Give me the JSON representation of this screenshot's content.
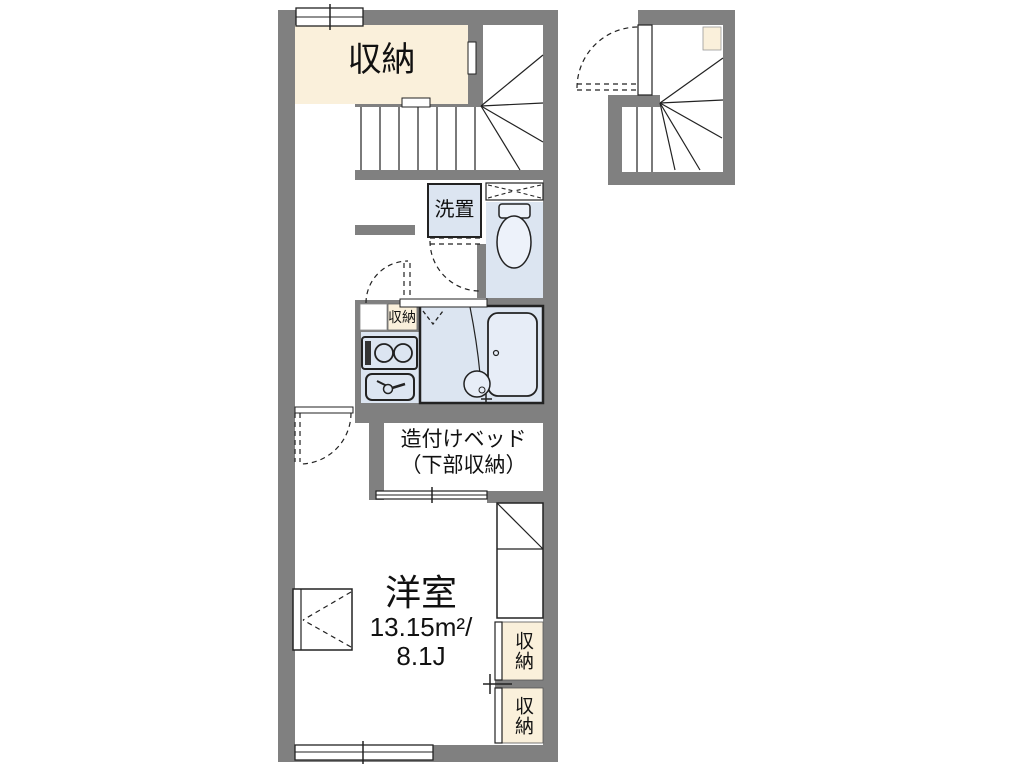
{
  "floorplan": {
    "colors": {
      "wall": "#808080",
      "closet": "#FAF0DB",
      "wet": "#DCE5F1",
      "outline": "#222222"
    },
    "upper_closet": {
      "label": "収納"
    },
    "washer_space": {
      "label": "洗置"
    },
    "small_closet": {
      "label": "収納"
    },
    "built_in_bed": {
      "line1": "造付けベッド",
      "line2": "（下部収納）"
    },
    "western_room": {
      "name": "洋室",
      "area_sqm": "13.15m²/",
      "area_tatami": "8.1J"
    },
    "right_closet_upper": {
      "label": "収納"
    },
    "right_closet_lower": {
      "label": "収納"
    }
  }
}
